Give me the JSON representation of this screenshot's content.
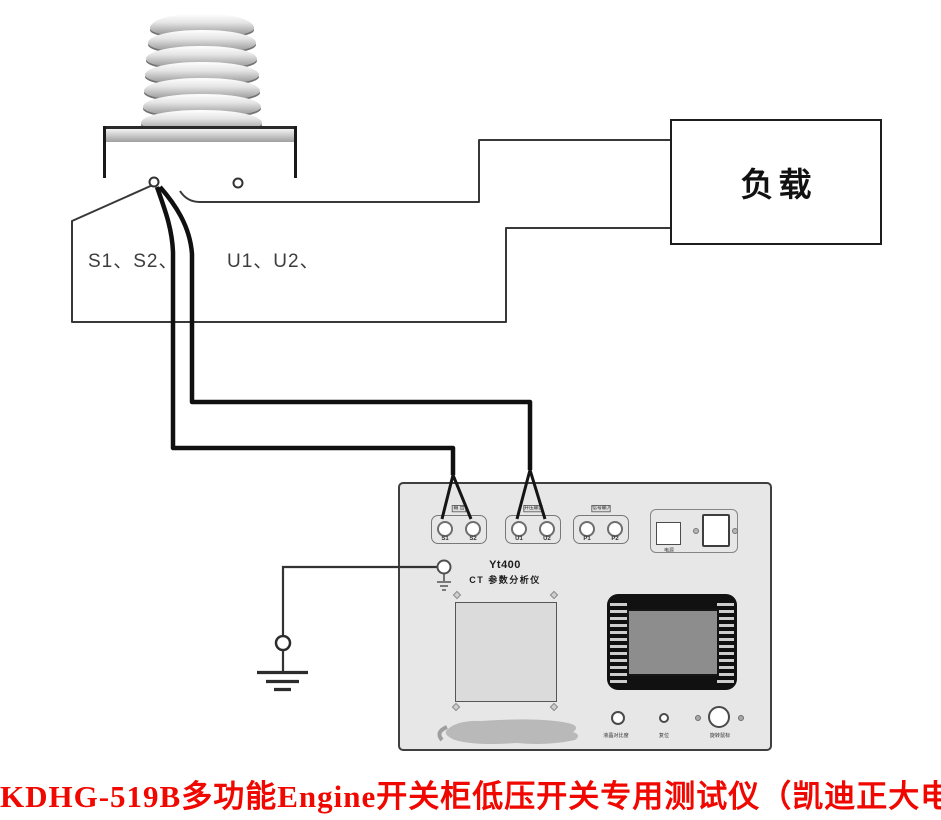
{
  "colors": {
    "caption_red": "#f00800",
    "wire_black": "#101010",
    "line_gray": "#383838",
    "panel_fill": "#e7e7e7",
    "screen_gray": "#8d8d8d"
  },
  "ct": {
    "secondary_label": "S1、S2、",
    "primary_label": "U1、U2、"
  },
  "load": {
    "label": "负载"
  },
  "instrument": {
    "brand": "Yt400",
    "subtitle": "CT 参数分析仪",
    "terminal_groups": [
      {
        "tag": "输 出",
        "terminals": [
          "S1",
          "S2"
        ]
      },
      {
        "tag": "升压输出",
        "terminals": [
          "U1",
          "U2"
        ]
      },
      {
        "tag": "信号输入",
        "terminals": [
          "P1",
          "P2"
        ]
      }
    ],
    "power_label": "电源",
    "buttons": [
      "液晶对比度",
      "复位",
      "旋转鼠标"
    ]
  },
  "caption": "KDHG-519B多功能Engine开关柜低压开关专用测试仪（凯迪正大电气）"
}
